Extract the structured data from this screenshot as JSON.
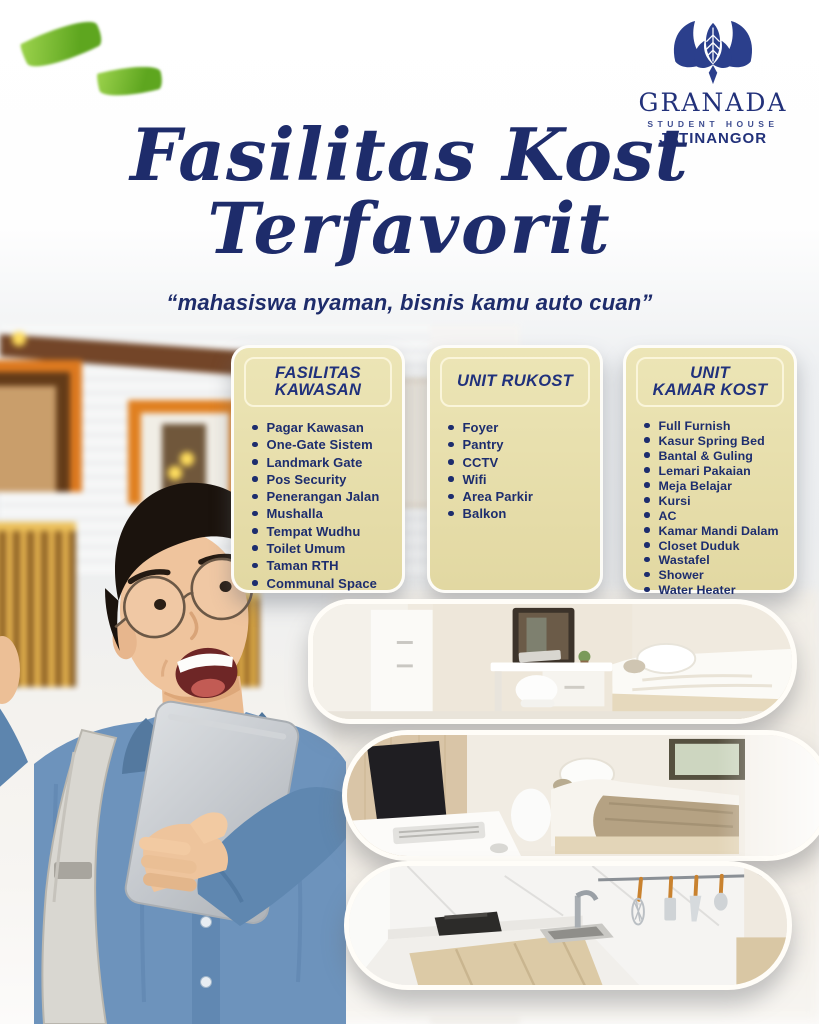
{
  "brand": {
    "name": "GRANADA",
    "subtitle": "STUDENT HOUSE",
    "location": "JATINANGOR"
  },
  "header": {
    "title_line1": "Fasilitas Kost",
    "title_line2": "Terfavorit",
    "tagline": "“mahasiswa nyaman, bisnis kamu auto cuan”"
  },
  "cards": [
    {
      "id": "fasilitas-kawasan",
      "title_lines": [
        "FASILITAS",
        "KAWASAN"
      ],
      "items": [
        "Pagar Kawasan",
        "One-Gate Sistem",
        "Landmark Gate",
        "Pos Security",
        "Penerangan Jalan",
        "Mushalla",
        "Tempat Wudhu",
        "Toilet Umum",
        "Taman RTH",
        "Communal Space"
      ]
    },
    {
      "id": "unit-rukost",
      "title_lines": [
        "UNIT RUKOST"
      ],
      "items": [
        "Foyer",
        "Pantry",
        "CCTV",
        "Wifi",
        "Area Parkir",
        "Balkon"
      ]
    },
    {
      "id": "unit-kamar-kost",
      "title_lines": [
        "UNIT",
        "KAMAR KOST"
      ],
      "items": [
        "Full Furnish",
        "Kasur Spring Bed",
        "Bantal & Guling",
        "Lemari Pakaian",
        "Meja Belajar",
        "Kursi",
        "AC",
        "Kamar Mandi Dalam",
        "Closet Duduk",
        "Wastafel",
        "Shower",
        "Water Heater"
      ]
    }
  ],
  "photos": [
    {
      "name": "bedroom-study-photo"
    },
    {
      "name": "bedroom-bed-photo"
    },
    {
      "name": "kitchen-pantry-photo"
    }
  ],
  "colors": {
    "navy": "#22317a",
    "navy_deep": "#1e2c6b",
    "card_bg": "#ece5b6",
    "leaf": "#76bb2f",
    "orange": "#d96f16",
    "gold": "#dcab41",
    "denim": "#6d93bc"
  }
}
